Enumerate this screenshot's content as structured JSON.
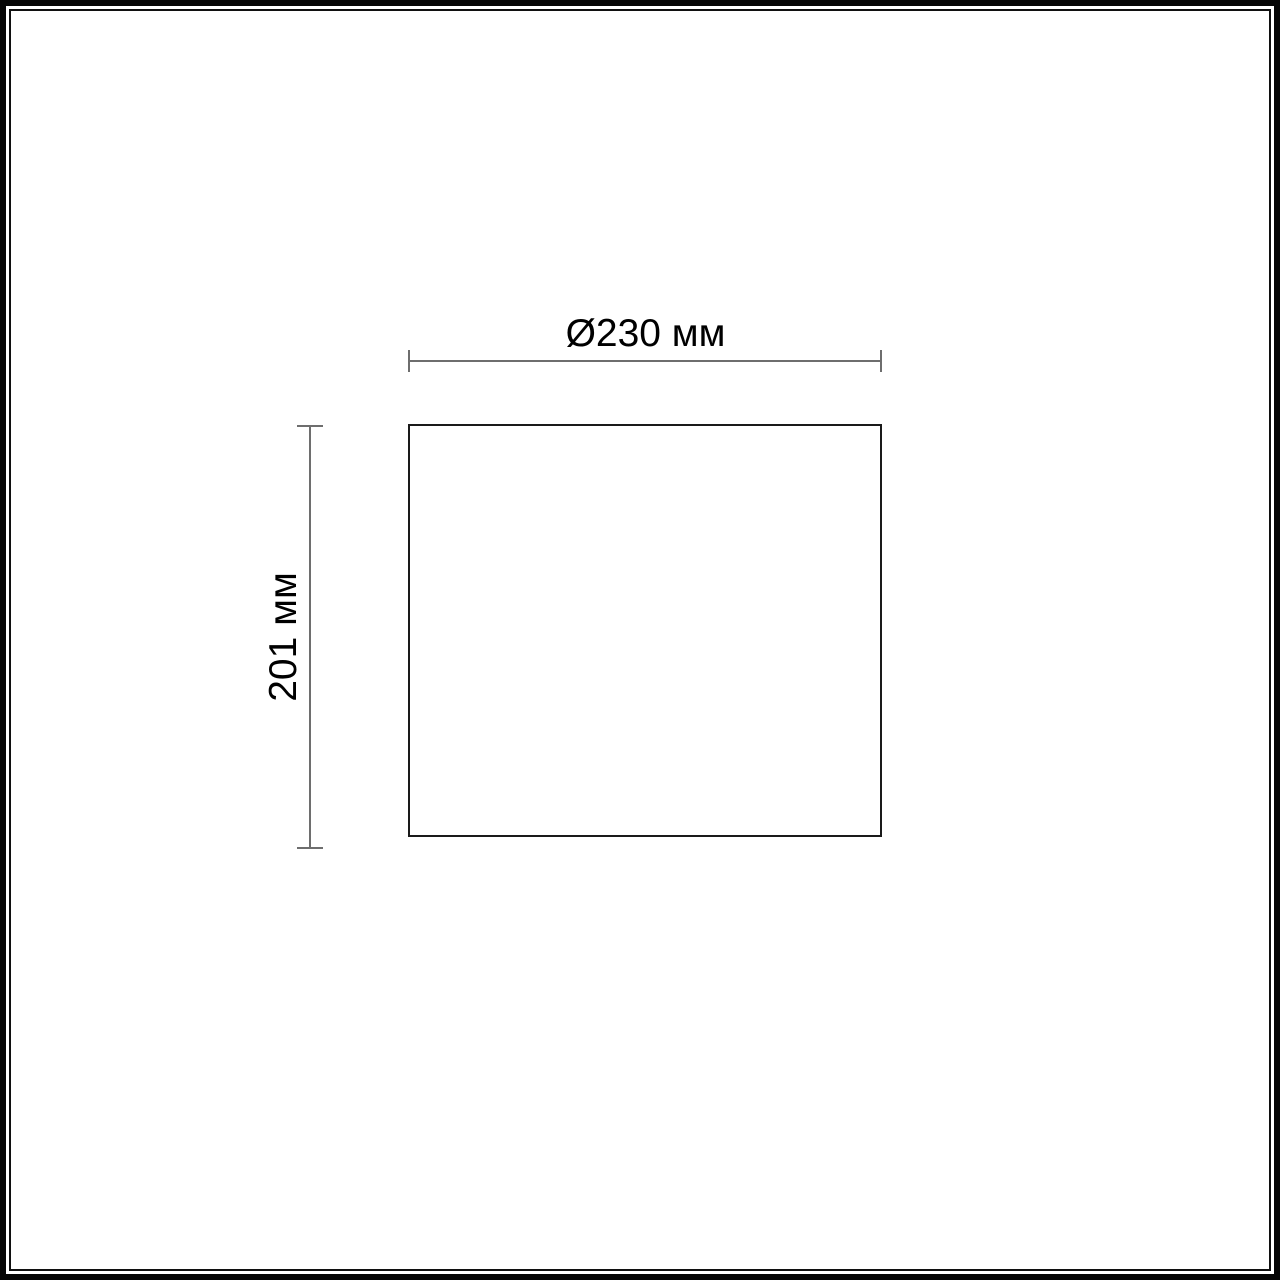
{
  "diagram": {
    "type": "technical-dimension-drawing",
    "shape": "rectangle-outline",
    "horizontal_dimension": {
      "label": "Ø230 мм",
      "value_mm": 230,
      "kind": "diameter"
    },
    "vertical_dimension": {
      "label": "201 мм",
      "value_mm": 201,
      "kind": "height"
    }
  },
  "colors": {
    "background": "#ffffff",
    "frame": "#050505",
    "outline": "#1a1a1a",
    "dimension_line": "#6e6e6e",
    "label_text": "#000000"
  }
}
